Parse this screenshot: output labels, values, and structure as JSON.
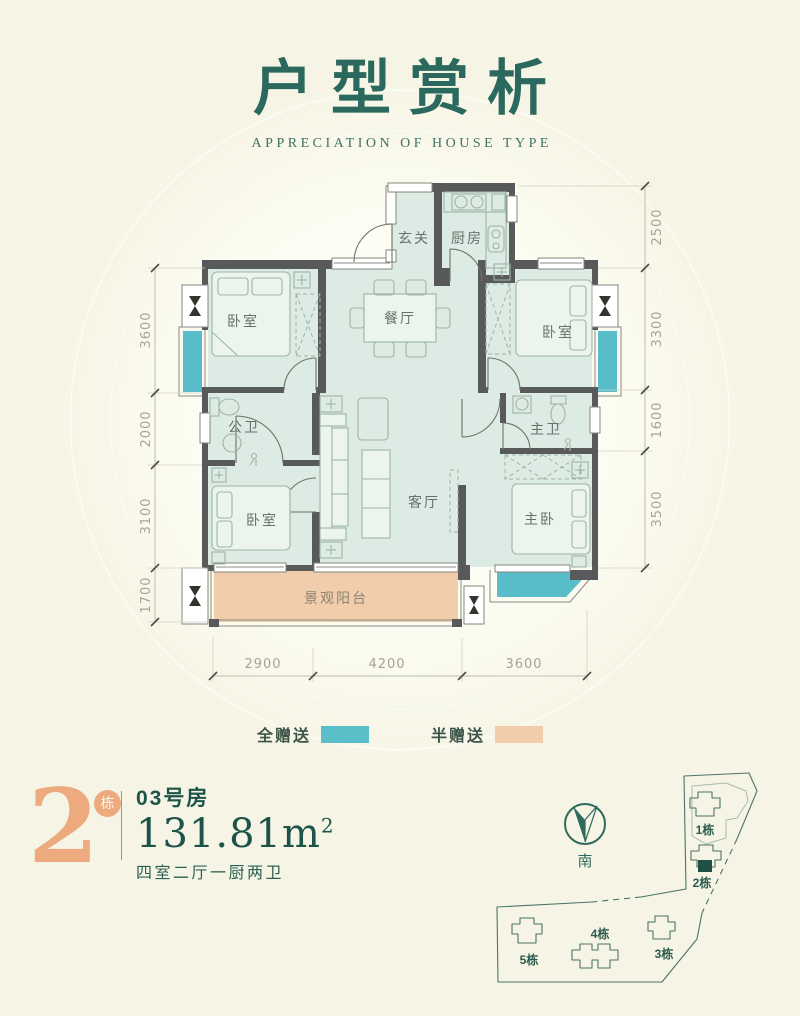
{
  "title": {
    "main": "户型赏析",
    "subtitle": "APPRECIATION OF HOUSE TYPE"
  },
  "floorplan": {
    "rooms": {
      "entry": "玄关",
      "kitchen": "厨房",
      "bedroom_top_left": "卧室",
      "bedroom_top_right": "卧室",
      "dining": "餐厅",
      "bath_public": "公卫",
      "living": "客厅",
      "bath_master": "主卫",
      "bedroom_bottom_left": "卧室",
      "bedroom_master": "主卧",
      "balcony": "景观阳台"
    },
    "dims_left": [
      "3600",
      "2000",
      "3100",
      "1700"
    ],
    "dims_right": [
      "2500",
      "3300",
      "1600",
      "3500"
    ],
    "dims_bottom": [
      "2900",
      "4200",
      "3600"
    ]
  },
  "legend": {
    "full": {
      "label": "全赠送",
      "color": "#5bbfca"
    },
    "half": {
      "label": "半赠送",
      "color": "#f2cdab"
    }
  },
  "unit": {
    "building": "2",
    "building_unit": "栋",
    "room": "03号房",
    "area": "131.81m",
    "area_sup": "2",
    "layout": "四室二厅一厨两卫"
  },
  "compass": {
    "south": "南"
  },
  "sitemap": {
    "b1": "1栋",
    "b2": "2栋",
    "b3": "3栋",
    "b4": "4栋",
    "b5": "5栋"
  }
}
